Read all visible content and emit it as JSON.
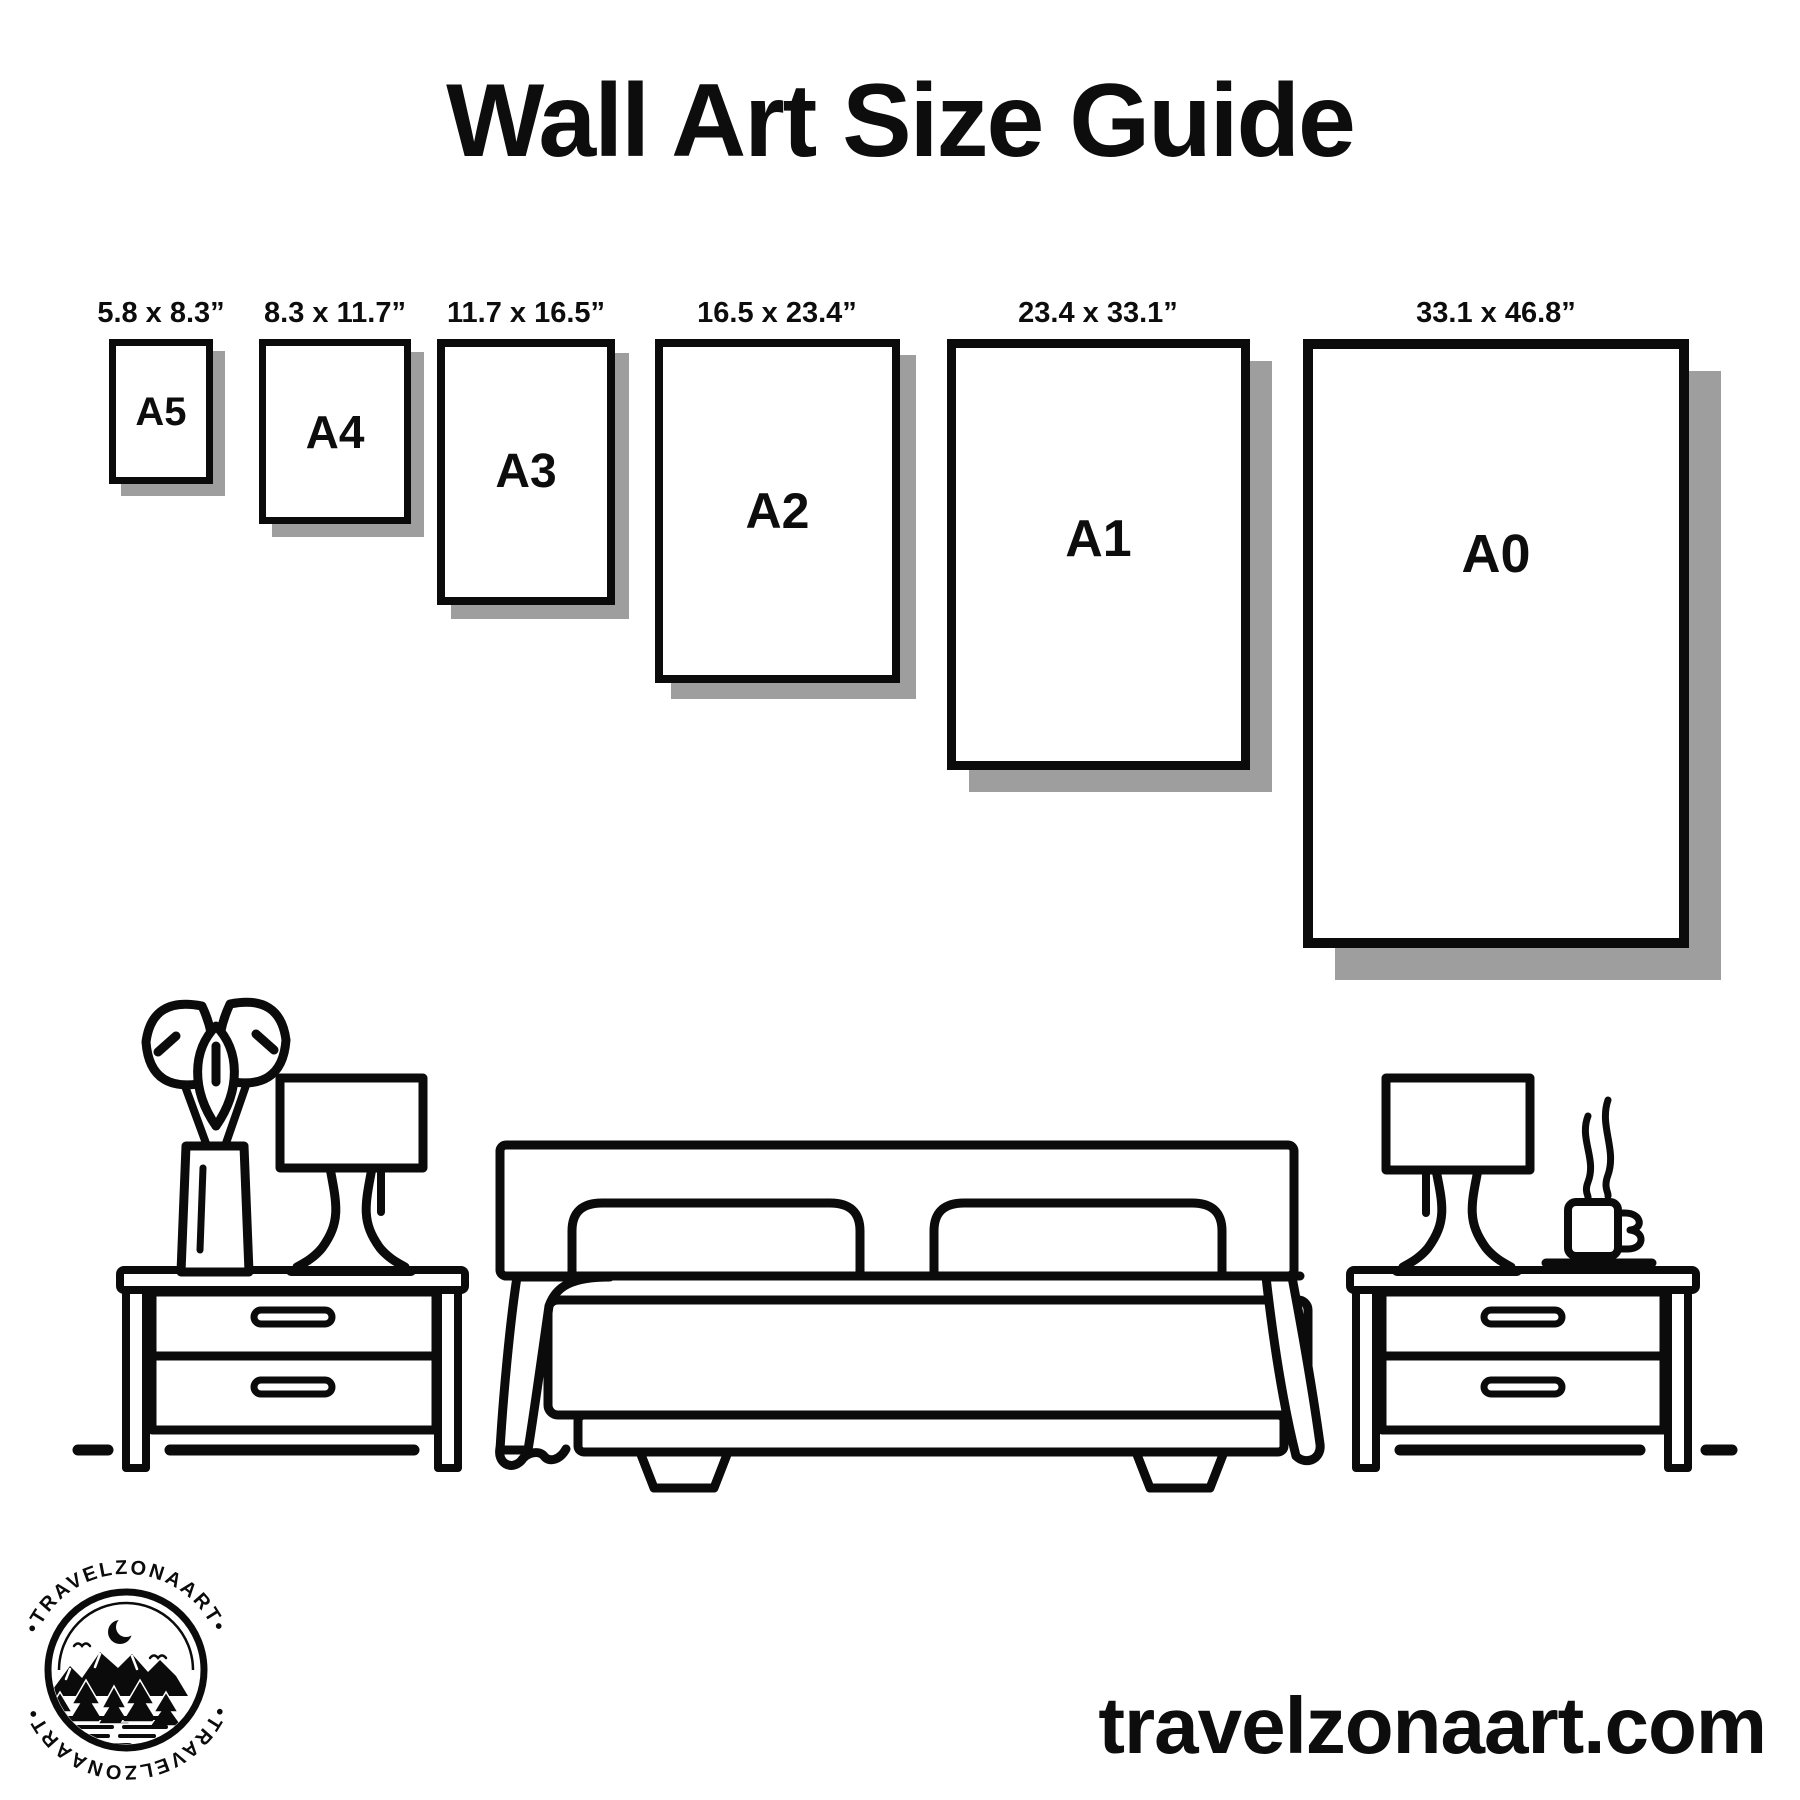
{
  "title": "Wall Art Size Guide",
  "sizes": [
    {
      "code": "A5",
      "dimensions": "5.8 x 8.3”"
    },
    {
      "code": "A4",
      "dimensions": "8.3 x 11.7”"
    },
    {
      "code": "A3",
      "dimensions": "11.7 x 16.5”"
    },
    {
      "code": "A2",
      "dimensions": "16.5 x 23.4”"
    },
    {
      "code": "A1",
      "dimensions": "23.4 x 33.1”"
    },
    {
      "code": "A0",
      "dimensions": "33.1 x 46.8”"
    }
  ],
  "footer": {
    "website": "travelzonaart.com"
  },
  "logo": {
    "brand": "TRAVELZONAART",
    "arc_top": "•TRAVELZONAART•",
    "arc_bottom": "•TRAVELZONAART•"
  },
  "colors": {
    "ink": "#0b0b0b",
    "shadow": "#9e9e9e",
    "background": "#ffffff"
  }
}
